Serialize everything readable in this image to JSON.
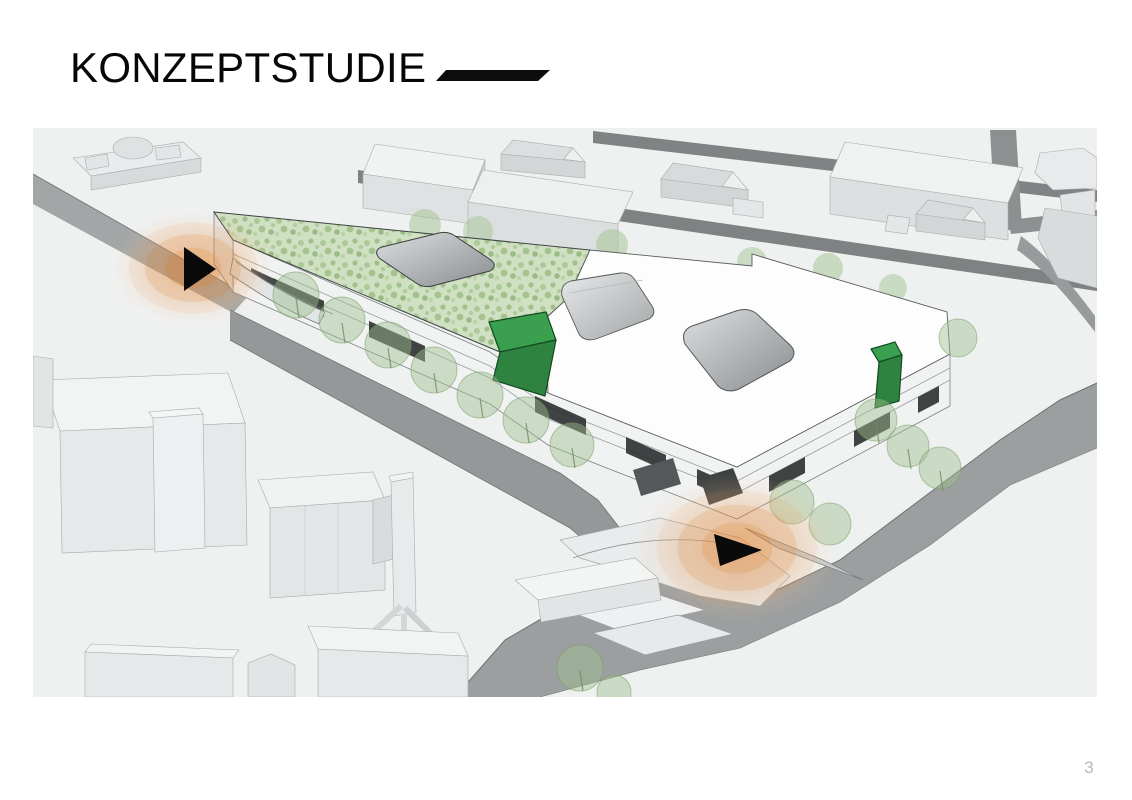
{
  "header": {
    "title": "KONZEPTSTUDIE"
  },
  "footer": {
    "page_number": "3"
  },
  "scene": {
    "colors": {
      "accent_green": "#3aa04f",
      "accent_green_dark": "#2e8340",
      "highlight_orange": "#e0893c",
      "green_roof": "#cfe0c3",
      "road_gray": "#9c9fa0",
      "ground": "#eff1f1",
      "building_white": "#fdfdfd"
    },
    "markers": [
      {
        "id": "left-entrance-marker",
        "icon": "arrow-right-icon"
      },
      {
        "id": "corner-entrance-marker",
        "icon": "arrow-right-icon"
      }
    ]
  }
}
